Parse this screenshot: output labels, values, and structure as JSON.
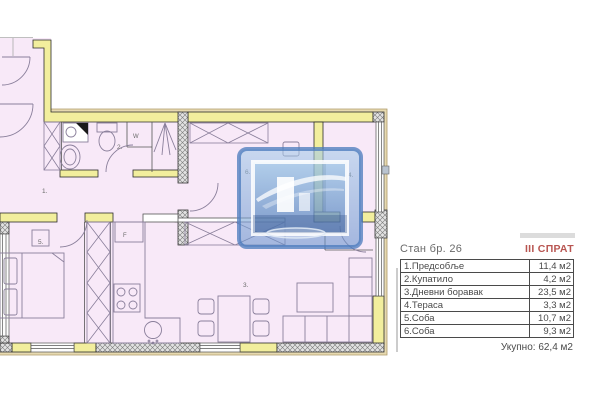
{
  "panel": {
    "apartment_label": "Стан бр. 26",
    "floor_label": "III СПРАТ",
    "rows": [
      {
        "name": "1.Предсобље",
        "area": "11,4 м2"
      },
      {
        "name": "2.Купатило",
        "area": "4,2 м2"
      },
      {
        "name": "3.Дневни боравак",
        "area": "23,5 м2"
      },
      {
        "name": "4.Тераса",
        "area": "3,3 м2"
      },
      {
        "name": "5.Соба",
        "area": "10,7 м2"
      },
      {
        "name": "6.Соба",
        "area": "9,3 м2"
      }
    ],
    "total_label": "Укупно:",
    "total_value": "62,4 м2"
  },
  "plan": {
    "room_labels": [
      {
        "text": "1."
      },
      {
        "text": "2."
      },
      {
        "text": "3."
      },
      {
        "text": "4."
      },
      {
        "text": "5."
      },
      {
        "text": "6."
      }
    ],
    "fixture_labels": {
      "wardrobe": "W",
      "fridge": "F"
    },
    "colors": {
      "room_fill": "#f8e9f8",
      "wall_yellow": "#f2ee9d",
      "hatch_gray": "#e2e2e2",
      "furniture_line": "#8a7f9b",
      "floor_red": "#b85551",
      "watermark_blue": "#6f9fd4"
    }
  }
}
